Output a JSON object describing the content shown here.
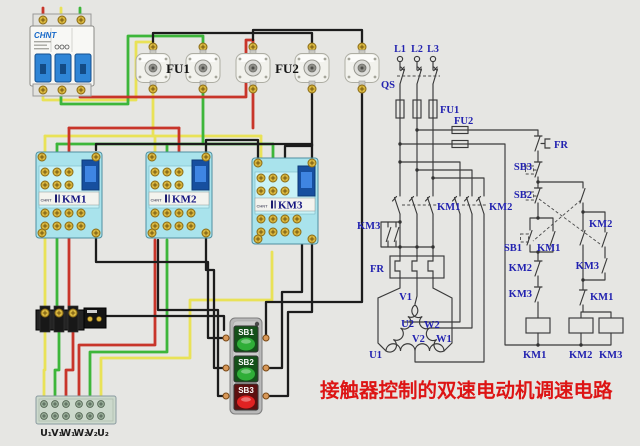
{
  "title": {
    "text": "接触器控制的双速电动机调速电路"
  },
  "colors": {
    "background": "#e6e6e3",
    "wire_yellow": "#e9e257",
    "wire_green": "#3db63a",
    "wire_red": "#c8352a",
    "wire_black": "#1c1c1c",
    "schematic_line": "#3a3a3a",
    "label_blue": "#2222b0",
    "title_red": "#dd1414",
    "contactor_body": "#a9e3ec",
    "breaker_toggle_blue": "#2f85d6",
    "button_green": "#2fae38",
    "button_red": "#e02222"
  },
  "physical": {
    "breaker": {
      "brand": "CHNT"
    },
    "fuse_group_labels": {
      "fu1": "FU1",
      "fu2": "FU2"
    },
    "contactor_brand": "CHNT",
    "contactors": [
      {
        "label": "KM1"
      },
      {
        "label": "KM2"
      },
      {
        "label": "KM3"
      }
    ],
    "buttons": [
      {
        "label": "SB1"
      },
      {
        "label": "SB2"
      },
      {
        "label": "SB3"
      }
    ],
    "terminal_labels": [
      "U₁",
      "V₁",
      "W₁",
      "W₂",
      "V₂",
      "U₂"
    ]
  },
  "schematic": {
    "phases": [
      "L1",
      "L2",
      "L3"
    ],
    "qs": "QS",
    "fu1": "FU1",
    "fu2": "FU2",
    "km1_main": "KM1",
    "km2_main": "KM2",
    "km3_main": "KM3",
    "fr_main": "FR",
    "fr_ctl": "FR",
    "sb1": "SB1",
    "sb2": "SB2",
    "sb3": "SB3",
    "km1_aux": "KM1",
    "km2_nc": "KM2",
    "km3_nc": "KM3",
    "km2_hold": "KM2",
    "km3_hold": "KM3",
    "km1_nc": "KM1",
    "coils": [
      "KM1",
      "KM2",
      "KM3"
    ],
    "motor": {
      "v1": "V1",
      "u2": "U2",
      "w2": "W2",
      "v2": "V2",
      "w1": "W1",
      "u1": "U1"
    }
  }
}
